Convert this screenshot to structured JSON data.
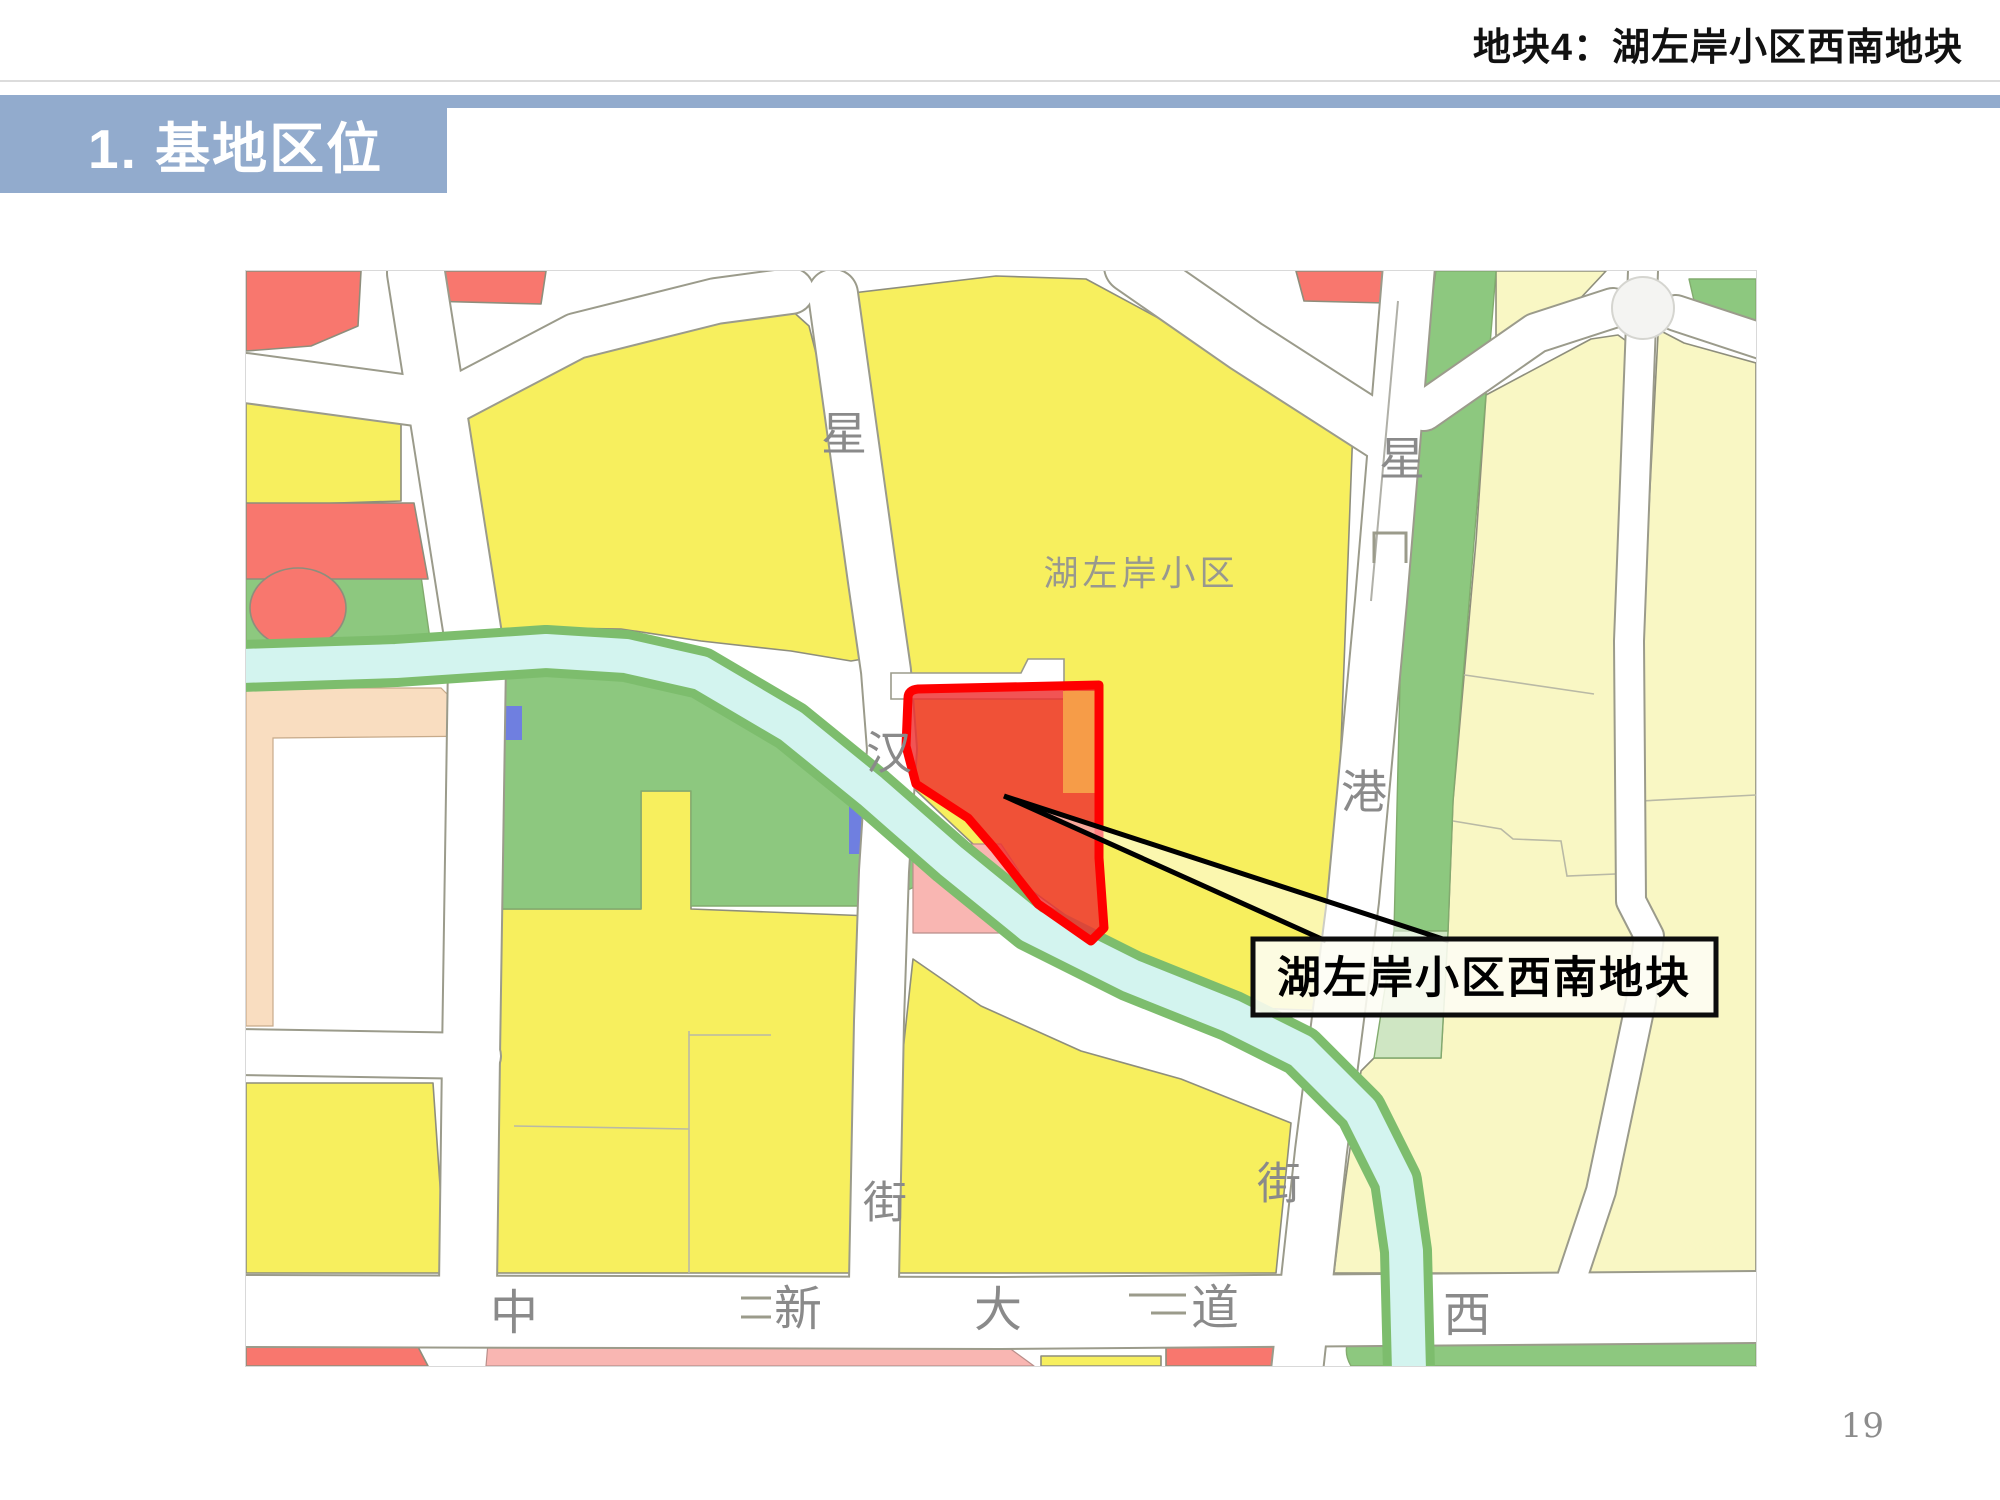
{
  "header": {
    "slide_title": "地块4：湖左岸小区西南地块",
    "section_title": "1. 基地区位"
  },
  "map": {
    "district_label": "湖左岸小区",
    "callout_label": "湖左岸小区西南地块",
    "road_labels": {
      "xing_nw": "星",
      "han": "汉",
      "jie_sw": "街",
      "xing_ne": "星",
      "gang": "港",
      "jie_se": "街",
      "zhong": "中",
      "xin": "新",
      "da": "大",
      "dao": "道",
      "xi": "西"
    },
    "colors": {
      "residential_yellow": "#f7ef5e",
      "residential_pale": "#f9f7c4",
      "green_space": "#8dc87f",
      "light_green": "#cfe6c3",
      "red_block": "#f8776e",
      "pink_block": "#f9b6b2",
      "peach_block": "#f9ddc0",
      "river_cyan": "#d3f4ef",
      "river_bank": "#7dbd6d",
      "plot_fill": "#ee2e2e",
      "plot_stroke": "#fe0000",
      "orange_block": "#f5a049",
      "road_white": "#ffffff",
      "label_gray": "#8a8a8a"
    }
  },
  "footer": {
    "page_number": "19"
  },
  "theme": {
    "accent_blue": "#92abcd"
  }
}
